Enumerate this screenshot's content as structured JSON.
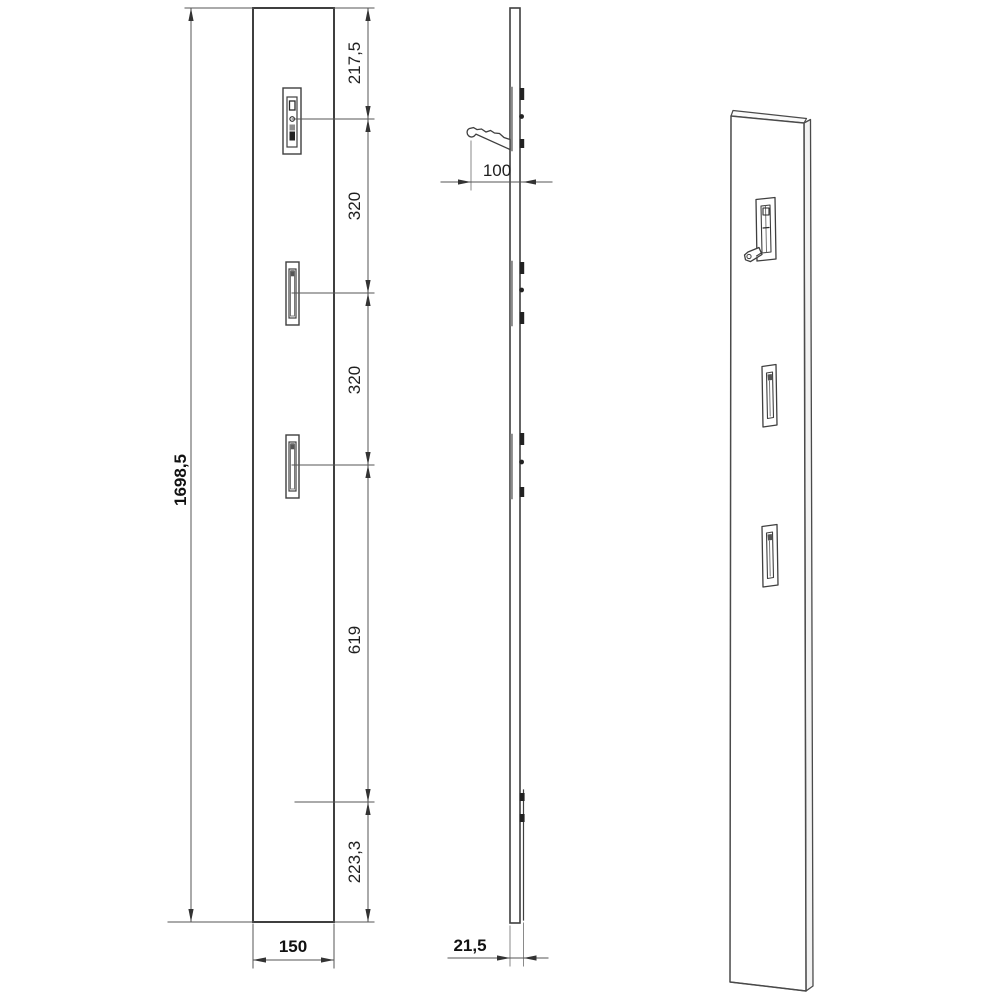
{
  "title": "Wall coat-rack panel technical drawing",
  "colors": {
    "background": "#ffffff",
    "line": "#3f3f3f",
    "thin_line": "#555555",
    "recess_gray": "#8a8a8a",
    "hardware_dark": "#222222",
    "text": "#1f1f1f"
  },
  "front_view": {
    "dims": {
      "overall_height": "1698,5",
      "top_to_hook1": "217,5",
      "hook1_to_hook2": "320",
      "hook2_to_hook3": "320",
      "hook3_to_bracket": "619",
      "bracket_to_bottom": "223,3",
      "width": "150"
    }
  },
  "side_view": {
    "dims": {
      "hook_projection": "100",
      "panel_thickness": "21,5"
    }
  }
}
